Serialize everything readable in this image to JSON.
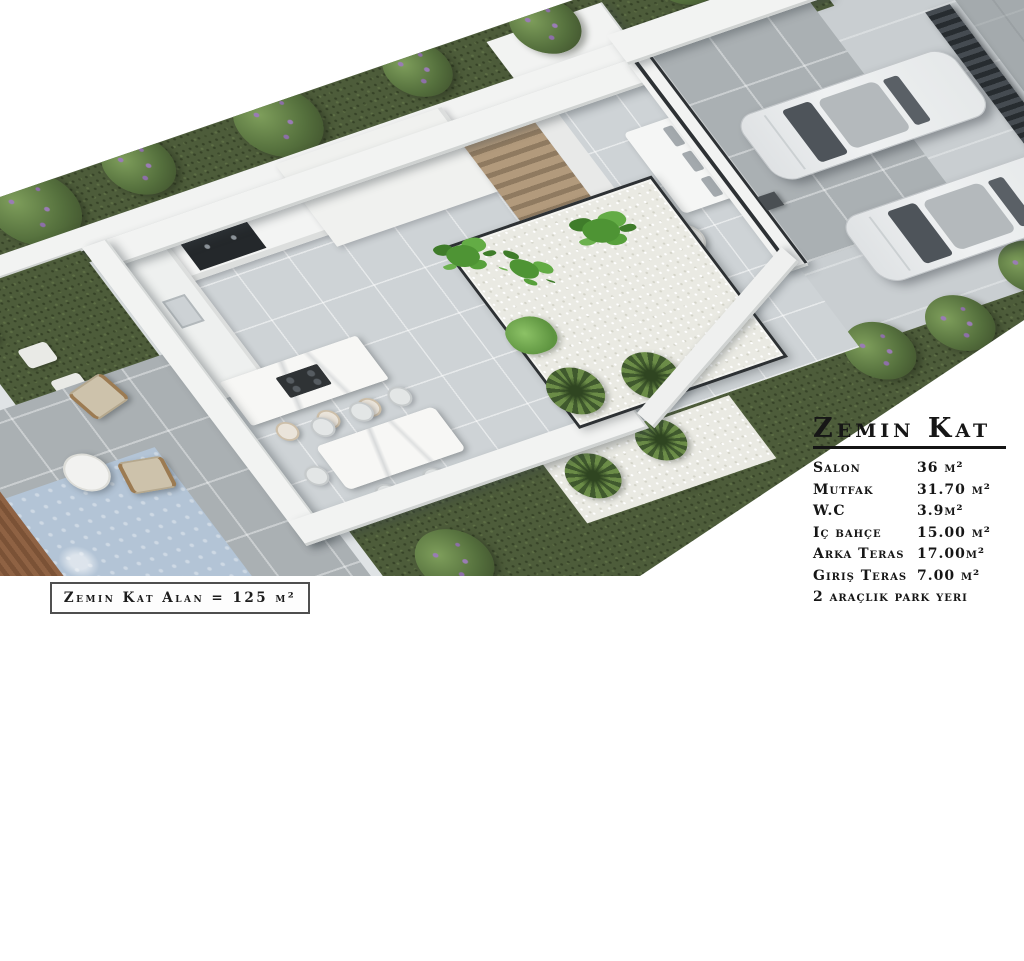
{
  "panel": {
    "title": "Zemin Kat",
    "rows": [
      {
        "label": "Salon",
        "value": "36 m²"
      },
      {
        "label": "Mutfak",
        "value": "31.70 m²"
      },
      {
        "label": "W.C",
        "value": "3.9m²"
      },
      {
        "label": "Iç bahçe",
        "value": "15.00 m²"
      },
      {
        "label": "Arka Teras",
        "value": "17.00m²"
      },
      {
        "label": "Giriş Teras",
        "value": "7.00 m²"
      },
      {
        "label": "2 araçlık park yeri",
        "value": ""
      }
    ]
  },
  "footer": {
    "area_label": "Zemin Kat Alan = 125 m²"
  },
  "scene": {
    "description": "3D isometric render of the ground floor plan with garden, kitchen, dining area, inner garden, living area, terraces, pool and two parked cars",
    "colors": {
      "lawn": "#4d5c3a",
      "bush_green": "#5f7d42",
      "bush_flower": "#9a7cb5",
      "wall_white": "#f2f3f2",
      "interior_floor": "#ced3d6",
      "terrace_tile": "#aab0b3",
      "pebbles": "#eaeae3",
      "pool_water": "#b3c4d6",
      "wood_deck": "#8a5f3f",
      "glass_frame": "#2d3134",
      "road": "#a4aaad",
      "fence": "#3b4045",
      "car_body": "#e9ebed",
      "stair_wood": "#b29a7c",
      "marble": "#f7f7f5"
    },
    "elements": [
      "hedge-row",
      "boundary-wall",
      "kitchen-cabinets",
      "kitchen-island",
      "bar-stools",
      "dining-set",
      "staircase",
      "inner-garden",
      "banana-plants",
      "ferns",
      "living-sofa",
      "coffee-table",
      "entry-terrace",
      "parked-cars",
      "fence",
      "road",
      "back-terrace",
      "lounge-chairs",
      "terrace-table",
      "pool",
      "wood-deck",
      "stepping-stones"
    ]
  }
}
